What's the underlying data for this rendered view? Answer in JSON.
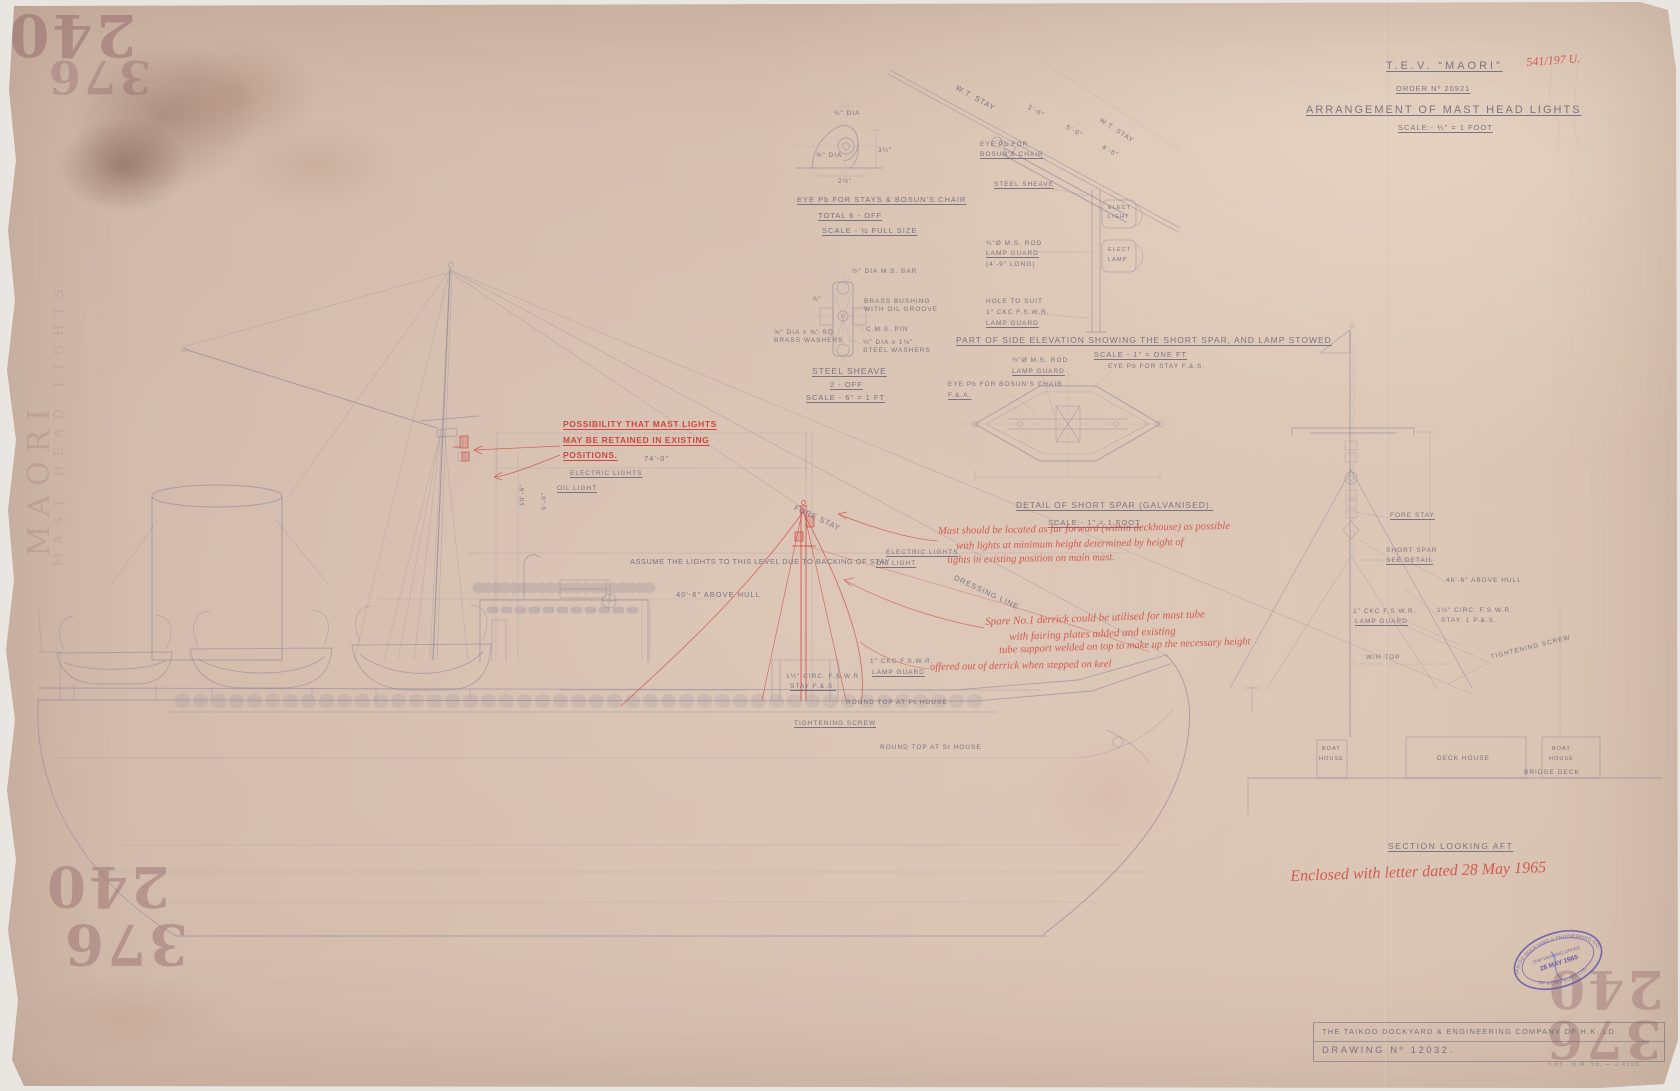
{
  "title_block": {
    "ship_name": "T.E.V.  “MAORI”",
    "order_no": "ORDER   Nº  20921",
    "drawing_title": "ARRANGEMENT  OF  MAST  HEAD  LIGHTS",
    "scale_note": "SCALE:-  ¼\" = 1 FOOT",
    "red_reference": "541/197 U."
  },
  "detail_eye": {
    "title": "EYE Pb FOR STAYS & BOSUN'S CHAIR",
    "qty": "TOTAL 6 - OFF",
    "scale": "SCALE - ½ FULL SIZE",
    "d1": "¾\" DIA",
    "d2": "⅝\" DIA",
    "d3": "3¼\"",
    "d4": "2½\""
  },
  "detail_sheave": {
    "title": "STEEL SHEAVE",
    "qty": "2 - OFF",
    "scale": "SCALE - 6\" = 1 FT",
    "bar": "½\" DIA M.S. BAR",
    "bush1": "BRASS BUSHING",
    "bush2": "WITH OIL GROOVE",
    "pin": "C.M.S. PIN",
    "washer1": "¼\" DIA x 1⅛\"",
    "washer2": "STEEL WASHERS",
    "brass1": "⅝\" DIA x ⅝\" SQ",
    "brass2": "BRASS WASHERS",
    "dim": "⅞\""
  },
  "spar_elev": {
    "title": "PART OF SIDE ELEVATION SHOWING THE SHORT SPAR, AND LAMP STOWED",
    "scale": "SCALE - 1\" = ONE FT",
    "stay1": "W.T. STAY",
    "stay2": "W.T. STAY",
    "dim1": "1'-6\"",
    "dim2": "5'-0\"",
    "dim3": "4'-6\"",
    "eye1": "EYE Pb FOR",
    "eye2": "BOSUN'S CHAIR",
    "sheave": "STEEL SHEAVE",
    "rod1": "¾\"Ø M.S. ROD",
    "rod2": "LAMP GUARD",
    "rod3": "(4'-9\" LONG)",
    "hole1": "HOLE TO SUIT",
    "hole2": "1\" CKC F.S.W.R.",
    "hole3": "LAMP GUARD",
    "box1a": "ELECT",
    "box1b": "LIGHT",
    "box2a": "ELECT",
    "box2b": "LAMP"
  },
  "spar_plan": {
    "title": "DETAIL OF SHORT SPAR (GALVANISED).",
    "scale": "SCALE:- 1\" = 1 FOOT",
    "rod1": "¾\"Ø M.S. ROD",
    "rod2": "LAMP GUARD",
    "eye_stay": "EYE Pb FOR STAY F.&.S.",
    "eye_chair1": "EYE Pb FOR BOSUN'S CHAIR",
    "eye_chair2": "F.&.A."
  },
  "main_view": {
    "note1a": "POSSIBILITY THAT MAST LIGHTS",
    "note1b": "MAY BE RETAINED IN EXISTING",
    "note1c": "POSITIONS.",
    "electric_lights": "ELECTRIC LIGHTS",
    "oil_light": "OIL LIGHT",
    "dim74": "74'-0\"",
    "assume": "ASSUME THE LIGHTS TO THIS LEVEL DUE TO BACKING OF STAY",
    "above_hull": "40'-6\" ABOVE HULL",
    "fore_stay": "FORE  STAY",
    "dressing_line": "DRESSING   LINE",
    "circ1": "1½\" CIRC. F.S.W.R.",
    "circ2": "STAY  F.&.S.",
    "ckc1": "1\" CKC  F.S.W.R.",
    "ckc2": "LAMP GUARD",
    "tightening": "TIGHTENING SCREW",
    "round_top_pt": "ROUND TOP AT Pt HOUSE",
    "round_top_st": "ROUND TOP AT St HOUSE",
    "dim10": "10'-6\"",
    "dim9": "9'-0\""
  },
  "red_notes": {
    "n2a": "Mast should be located as far forward (within deckhouse) as possible",
    "n2b": "with lights at minimum height determined by height of",
    "n2c": "lights in existing position on main mast.",
    "n3a": "Spare No.1 derrick could be utilised for mast tube",
    "n3b": "with fairing plates added and existing",
    "n3c": "tube support welded on top to make up the necessary height",
    "n4": "offered out of derrick when stepped on keel",
    "n5": "Enclosed with letter dated 28 May 1965"
  },
  "section_view": {
    "fore_stay": "FORE STAY",
    "spar1": "SHORT SPAR",
    "spar2": "SEE DETAIL",
    "above_hull": "46'-6\" ABOVE HULL",
    "guard1": "1\" CKC F.S.W.R.",
    "guard2": "LAMP GUARD",
    "stay1": "1½\" CIRC. F.S.W.R.",
    "stay2": "STAY. 1 P.&.S.",
    "wh_top": "W/H TOP",
    "tightening": "TIGHTENING SCREW",
    "box1a": "BOAT",
    "box1b": "HOUSE",
    "deck_house": "DECK  HOUSE",
    "box3a": "BOAT",
    "box3b": "HOUSE",
    "bridge_deck": "BRIDGE  DECK",
    "title": "SECTION  LOOKING  AFT"
  },
  "stamp": {
    "ring_top": "TAIKOO DOCKYARD & ENGINEERING CO.",
    "ring_bottom": "OF HONG KONG LTD.",
    "office": "SHIP DRAWING OFFICE",
    "date": "28 MAY 1965"
  },
  "footer": {
    "company": "THE TAIKOO DOCKYARD & ENGINEERING COMPANY OF H.K. LD.",
    "drawing_no": "DRAWING  Nº  12032.",
    "print_code": "5.65 · B.M. 5d. — 2.4153."
  },
  "bleedthrough": {
    "n240": "240",
    "n376": "376",
    "vertical1": "MAORI",
    "vertical2": "MAST HEAD LIGHTS"
  }
}
